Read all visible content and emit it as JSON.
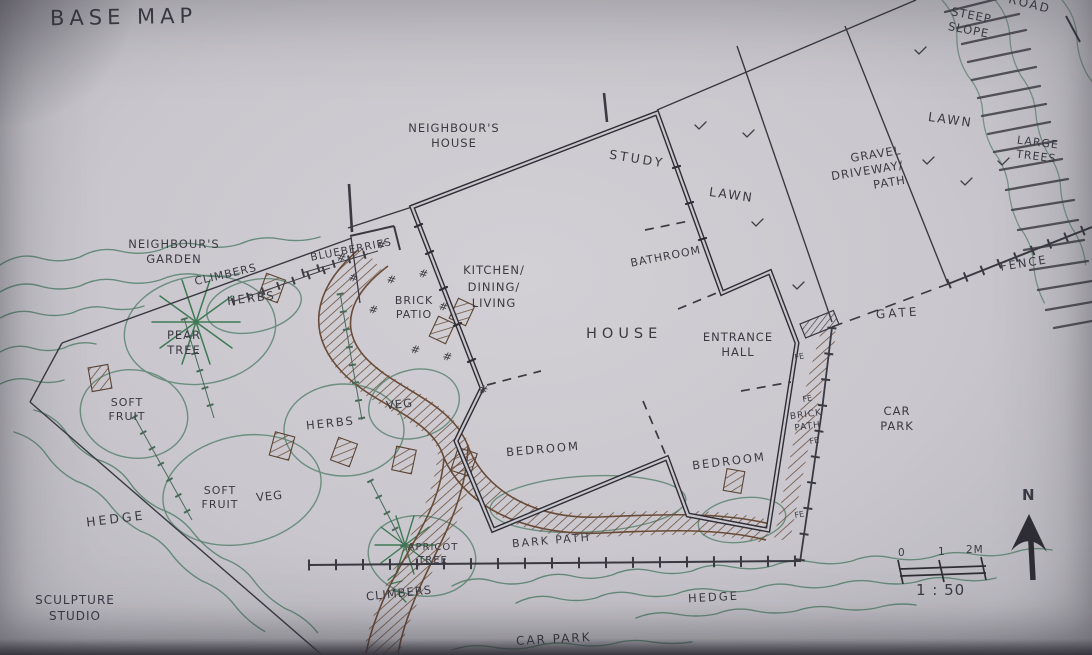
{
  "title": "BASE MAP",
  "colors": {
    "paper": "#c9c7cd",
    "ink": "#3b3a43",
    "plant_green": "#5b8470",
    "path_brown": "#6a4b38"
  },
  "labels": {
    "neighbours_house": "NEIGHBOUR'S\nHOUSE",
    "neighbours_garden": "NEIGHBOUR'S\nGARDEN",
    "study": "STUDY",
    "lawn_upper": "LAWN",
    "lawn_right": "LAWN",
    "gravel_driveway": "GRAVEL\nDRIVEWAY/\nPATH",
    "steep_slope": "STEEP\nSLOPE",
    "road": "ROAD",
    "large_trees": "LARGE\nTREES",
    "fence": "FENCE",
    "gate": "GATE",
    "blueberries": "BLUEBERRIES",
    "climbers_upper": "CLIMBERS",
    "herbs_upper": "HERBS",
    "pear_tree": "PEAR\nTREE",
    "brick_patio": "BRICK\nPATIO",
    "kitchen_dining_living": "KITCHEN/\nDINING/\nLIVING",
    "bathroom": "BATHROOM",
    "house": "HOUSE",
    "entrance_hall": "ENTRANCE\nHALL",
    "soft_fruit_upper": "SOFT\nFRUIT",
    "herbs_mid": "HERBS",
    "veg_upper": "VEG",
    "bedroom_left": "BEDROOM",
    "bedroom_right": "BEDROOM",
    "brick_path": "BRICK\nPATH",
    "car_park_right": "CAR\nPARK",
    "soft_fruit_lower": "SOFT\nFRUIT",
    "veg_lower": "VEG",
    "hedge_left": "HEDGE",
    "apricot_tree": "APRICOT\nTREE",
    "bark_path": "BARK PATH",
    "climbers_lower": "CLIMBERS",
    "hedge_lower": "HEDGE",
    "sculpture_studio": "SCULPTURE\nSTUDIO",
    "car_park_lower": "CAR PARK",
    "fence_post_mark": "FE",
    "patio_brick_mark": "#"
  },
  "compass": {
    "north_label": "N"
  },
  "scale_bar": {
    "tick_0": "0",
    "tick_1": "1",
    "tick_2": "2M",
    "ratio": "1 : 50"
  }
}
